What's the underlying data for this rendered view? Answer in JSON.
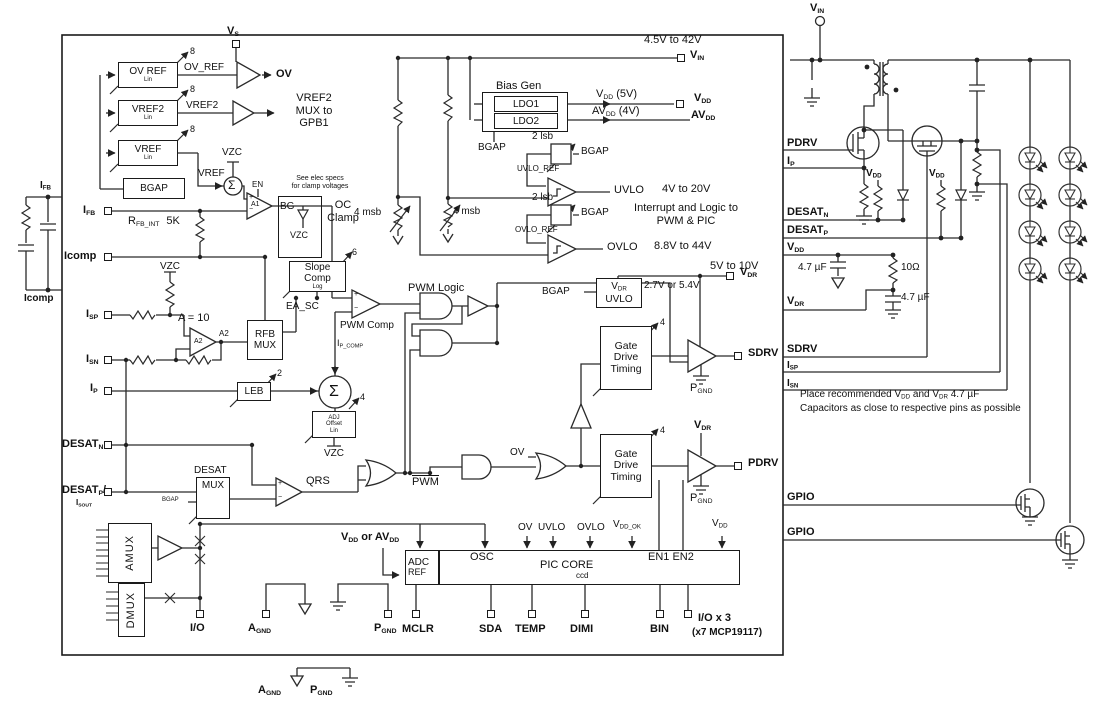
{
  "sym": {
    "sigma": "Σ",
    "plus": "+",
    "minus": "−",
    "bus8": "8",
    "bus6": "6",
    "bus4": "4",
    "bus2": "2"
  },
  "refs": {
    "ov_ref": "OV REF",
    "vref2": "VREF2",
    "vref": "VREF",
    "lin": "Lin",
    "bgap": "BGAP",
    "ov_ref_sig": "OV_REF",
    "ov": "OV",
    "vref2_sig": "VREF2",
    "mux1": "VREF2",
    "mux2": "MUX to",
    "mux3": "GPB1",
    "vref_sig": "VREF",
    "vzc": "VZC",
    "en": "EN",
    "a1": "A1",
    "see1": "See elec specs",
    "see2": "for clamp voltages",
    "bg": "BG",
    "oc1": "OC",
    "oc2": "Clamp"
  },
  "pins": {
    "vs_b": "V",
    "vs_s": "S",
    "i": "I",
    "fb": "FB",
    "icomp": "Icomp",
    "sp": "SP",
    "sn": "SN",
    "p": "P",
    "desat": "DESAT",
    "n_s": "N",
    "p_s": "P",
    "slash": "/",
    "sout": "SOUT",
    "io": "I/O",
    "a": "A",
    "gnd": "GND",
    "mclr": "MCLR",
    "sda": "SDA",
    "temp": "TEMP",
    "dimi": "DIMI",
    "bin": "BIN",
    "iox3": "I/O x 3",
    "x7": "(x7 MCP19117)",
    "v": "V",
    "av": "AV",
    "in_s": "IN",
    "dd": "DD",
    "dr": "DR",
    "sdrv": "SDRV",
    "pdrv": "PDRV",
    "gpio": "GPIO"
  },
  "mid": {
    "r": "R",
    "rfbint": "FB_INT",
    "r5k": "5K",
    "msb4": "4 msb",
    "a10": "A = 10",
    "a2": "A2",
    "slope1": "Slope",
    "slope2": "Comp",
    "slope3": "Log",
    "ea_sc": "EA_SC",
    "pwm_comp": "PWM Comp",
    "pwm_logic": "PWM Logic",
    "ip1": "I",
    "ip2": "P_COMP",
    "rfb": "RFB",
    "mux": "MUX",
    "leb": "LEB",
    "adj1": "ADJ",
    "adj2": "Offset",
    "adj3": "Lin",
    "desat": "DESAT",
    "qrs": "QRS",
    "pwm": "PWM",
    "amux": "AMUX",
    "dmux": "DMUX"
  },
  "top": {
    "bias": "Bias Gen",
    "ldo1": "LDO1",
    "ldo2": "LDO2",
    "v5": " (5V)",
    "v4": " (4V)",
    "lsb2": "2 lsb",
    "uvloref": "UVLO_REF",
    "ovloref": "OVLO_REF",
    "uvlo": "UVLO",
    "ovlo": "OVLO",
    "rvin": "4.5V to 42V",
    "ruvlo": "4V to 20V",
    "rovlo": "8.8V to 44V",
    "rvdr": "5V to 10V",
    "int1": "Interrupt and Logic to",
    "int2": "PWM & PIC",
    "v2754": "2.7V or 5.4V"
  },
  "gd": {
    "g1": "Gate",
    "g2": "Drive",
    "g3": "Timing"
  },
  "pic": {
    "adc": "ADC",
    "ref": "REF",
    "osc": "OSC",
    "core": "PIC CORE",
    "ccd": "ccd",
    "en12": "EN1 EN2",
    "ddok": "DD_OK",
    "or": " or "
  },
  "ext": {
    "c47": "4.7 µF",
    "r10": "10Ω",
    "n1a": "Place recommended ",
    "n1b": " and ",
    "n1c": " 4.7 µF",
    "n2": "Capacitors as close to respective pins as possible"
  }
}
